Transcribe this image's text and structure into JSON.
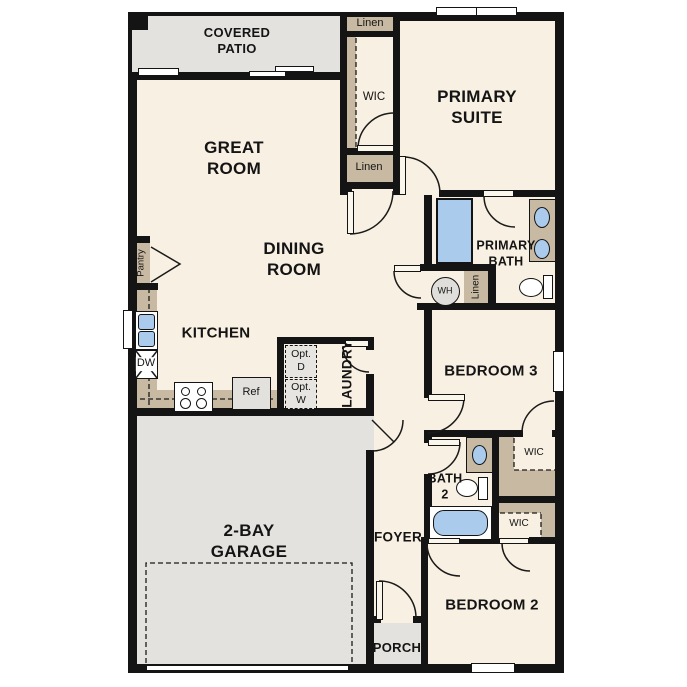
{
  "rooms": {
    "covered_patio": {
      "l1": "COVERED",
      "l2": "PATIO"
    },
    "great_room": {
      "l1": "GREAT",
      "l2": "ROOM"
    },
    "dining_room": {
      "l1": "DINING",
      "l2": "ROOM"
    },
    "kitchen": {
      "l1": "KITCHEN"
    },
    "primary_suite": {
      "l1": "PRIMARY",
      "l2": "SUITE"
    },
    "primary_bath": {
      "l1": "PRIMARY",
      "l2": "BATH"
    },
    "bedroom_3": {
      "l1": "BEDROOM 3"
    },
    "bath_2": {
      "l1": "BATH",
      "l2": "2"
    },
    "bedroom_2": {
      "l1": "BEDROOM 2"
    },
    "foyer": {
      "l1": "FOYER"
    },
    "laundry": {
      "l1": "LAUNDRY"
    },
    "garage": {
      "l1": "2-BAY",
      "l2": "GARAGE"
    },
    "porch": {
      "l1": "PORCH"
    }
  },
  "closets": {
    "linen_upper": "Linen",
    "wic_primary": "WIC",
    "linen_hall": "Linen",
    "linen_bath": "Linen",
    "pantry": "Pantry",
    "wic_bedroom3": "WIC",
    "wic_bedroom2": "WIC"
  },
  "appliances": {
    "dishwasher": "DW",
    "refrigerator": "Ref",
    "water_heater": "WH",
    "opt_dryer": {
      "l1": "Opt.",
      "l2": "D"
    },
    "opt_washer": {
      "l1": "Opt.",
      "l2": "W"
    }
  },
  "colors": {
    "floor_cream": "#f8f0e2",
    "closet_tan": "#c8b9a2",
    "exterior_gray": "#e3e2de",
    "fixture_blue": "#aacbec",
    "wall_black": "#141414"
  }
}
